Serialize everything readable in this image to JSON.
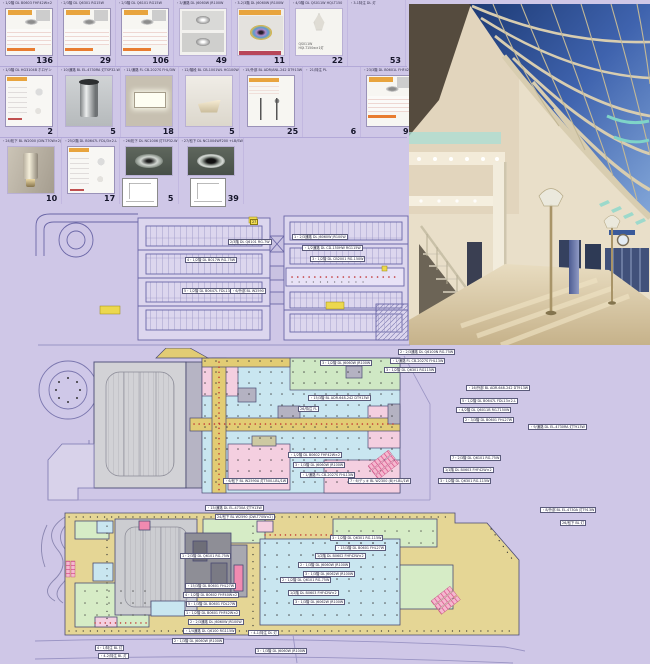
{
  "palette": {
    "page_bg": "#cfc7e7",
    "grid_line": "#b3a9d8",
    "plan_line": "#6a66a6",
    "plan_fill": "#dcd6ee",
    "zone_cyan": "#c9e6f0",
    "zone_pink": "#f4cfe0",
    "zone_green": "#d4ebc5",
    "zone_yellow": "#e2cc74",
    "zone_tan": "#e5d695",
    "zone_grey": "#cccdd1",
    "dot_red": "#c03030",
    "sky_blue": "#3c5ea8",
    "mullion_cream": "#d8cdb0",
    "teal_accent": "#7fd4c8",
    "floor_beige": "#d9c7a3"
  },
  "catalog": {
    "rows": [
      {
        "cards": [
          {
            "header": "・1/2階  DL  B0603  FHF42W×2",
            "number": "136",
            "variant": "sheet"
          },
          {
            "header": "・2/3階  DL  Q6301  RG15W",
            "number": "29",
            "variant": "sheet"
          },
          {
            "header": "・2/3階  DL  Q6101  RG15W",
            "number": "106",
            "variant": "sheet"
          },
          {
            "header": "・3/通路  DL  J6060W  JR100W",
            "number": "49",
            "variant": "stack"
          },
          {
            "header": "・3-2/3階  DL  J6060W  JR100W",
            "number": "11",
            "variant": "photoDL"
          },
          {
            "header": "・4/3階  DL  QS011W  HQI-T150",
            "number": "22",
            "variant": "sketch",
            "note": "QS011W\nHQI-T150w×1灯"
          },
          {
            "header": "・3-1特注  DL  灯",
            "number": "53",
            "variant": "empty"
          }
        ]
      },
      {
        "cards": [
          {
            "header": "・1/3階  DL  HG3104B  ホロゲン",
            "number": "2",
            "variant": "sheetB"
          },
          {
            "header": "・10/通路  BL  EL-4730RA  灯TSP32-W",
            "number": "5",
            "variant": "cylinder"
          },
          {
            "header": "・11/通路  FL  CB-2027S  FHL/3W",
            "number": "18",
            "variant": "rectlight"
          },
          {
            "header": "・12/階段  BL  CB-1001WL  HG100W",
            "number": "5",
            "variant": "wedge"
          },
          {
            "header": "・15/外部  BL  ADR/ANL-242  DT913W",
            "number": "25",
            "variant": "poleSheet"
          },
          {
            "header": "・ 21/特注  PL",
            "number": "6",
            "variant": "empty"
          },
          {
            "header": "・23/3階  DL  B0601L  FHF42W",
            "number": "97",
            "variant": "sheet"
          }
        ]
      },
      {
        "cards": [
          {
            "header": "・24/松下  BL  W2000  (DW-T70W×2)",
            "number": "10",
            "variant": "wallcyl"
          },
          {
            "header": "・25/2階  DL  B0647L  FDL/3×2-L",
            "number": "17",
            "variant": "sheetB"
          },
          {
            "header": "・26/松下  DL  NC1006  灯TSP32-W",
            "number": "5",
            "variant": "darkDL"
          },
          {
            "header": "・27/松下  DL  NC1004WF200  +LB/SW",
            "number": "39",
            "variant": "darkDL2"
          }
        ]
      }
    ]
  },
  "plans": {
    "cad": {
      "title": "parking-level-plan",
      "labels": [
        {
          "text": "4・1/2階  DL  B017W  RG-75W",
          "x": 155,
          "y": 49
        },
        {
          "text": "5・1/2階  DL  B0647L  FDL13-L",
          "x": 152,
          "y": 80
        },
        {
          "text": "1・2/3通路  DL  J6060W  JR100W",
          "x": 262,
          "y": 26
        },
        {
          "text": "・1/2通路  DL  CD-150HW  RG115W",
          "x": 272,
          "y": 37
        },
        {
          "text": "3・1/2階  DL  CB2001  RG-150W",
          "x": 280,
          "y": 48
        },
        {
          "text": "2/3階  DL  Q6101  RG-7W",
          "x": 198,
          "y": 31
        },
        {
          "text": "・6/外部  BL  W2590",
          "x": 200,
          "y": 80
        },
        {
          "text": "27",
          "x": 220,
          "y": 11,
          "variant": "yellow"
        }
      ]
    },
    "level1": {
      "title": "upper-floor-plan",
      "labels": [
        {
          "text": "2・2/3通路  DL  Q6100N  RG-75W",
          "x": 360,
          "y": 1
        },
        {
          "text": "・1/通路  FL  CB-2027S  FHL13W",
          "x": 352,
          "y": 10
        },
        {
          "text": "3・1/2階  DL  Q6301  RG115W",
          "x": 346,
          "y": 19
        },
        {
          "text": "3・1/2階  DL  J6060W  JR100W",
          "x": 282,
          "y": 12
        },
        {
          "text": "・16/外部  BL  ADR-648-242  DT913W",
          "x": 428,
          "y": 37
        },
        {
          "text": "5・1/2階  DL  B0647L  FDL13×2-L",
          "x": 422,
          "y": 50
        },
        {
          "text": "・4/2階  DL  Q6011B  RG-T150W",
          "x": 418,
          "y": 59
        },
        {
          "text": "2・3/3階  DL  B0601  FHL27W",
          "x": 425,
          "y": 69
        },
        {
          "text": "・15/3階  BL  ADR-648-242  DT913W",
          "x": 270,
          "y": 47
        },
        {
          "text": "26/特注  FL",
          "x": 260,
          "y": 58
        },
        {
          "text": "7・2/3階  DL  Q6101  RG-75W",
          "x": 412,
          "y": 107
        },
        {
          "text": "1/1階  DL  B0603  FHF42W×2",
          "x": 405,
          "y": 119
        },
        {
          "text": "3・1/2階  DL  Q6301  RG-115W",
          "x": 400,
          "y": 130
        },
        {
          "text": "・1/2階  DL  B0602  FHF42W×2",
          "x": 250,
          "y": 104
        },
        {
          "text": "3・1/3階  DL  J6060W  JR100W",
          "x": 255,
          "y": 114
        },
        {
          "text": "・1/通路  FL  CB-2027S  FHL13W",
          "x": 262,
          "y": 124
        },
        {
          "text": "・9/通路  DL  EL-4730RA  灯T913W",
          "x": 490,
          "y": 76
        },
        {
          "text": "・6/松下  BL  W2590A  灯T500-LBL/1W",
          "x": 185,
          "y": 130
        },
        {
          "text": "7・6/デッキ  BL  W2300  (B)+LBL/1W",
          "x": 310,
          "y": 130
        }
      ]
    },
    "ground": {
      "title": "ground-floor-plan",
      "labels": [
        {
          "text": "・8/外部  BL  EL-4730A  灯T913W",
          "x": 505,
          "y": 2
        },
        {
          "text": "26/松下  BL  灯",
          "x": 525,
          "y": 15
        },
        {
          "text": "・15/通路  DL  EL-4730A  灯T913W",
          "x": 170,
          "y": 0
        },
        {
          "text": "24/松下  BL  W2590  (DW-T70W×2)",
          "x": 180,
          "y": 9
        },
        {
          "text": "3・1/2階  DL  Q6301  RG-115W",
          "x": 295,
          "y": 30
        },
        {
          "text": "・15/3階  DL  B0601  FHL27W",
          "x": 300,
          "y": 40
        },
        {
          "text": "1/2階  DL  B0602  FHF42W×2",
          "x": 280,
          "y": 48
        },
        {
          "text": "2・1/3階  DL  J6060W  JR100W",
          "x": 263,
          "y": 57
        },
        {
          "text": "3・1/3階  DL  J6062W  JR100W",
          "x": 268,
          "y": 66
        },
        {
          "text": "1・2/3階  DL  Q6101  RG-75W",
          "x": 145,
          "y": 48
        },
        {
          "text": "2・1/2階  DL  Q6101  RG-75W",
          "x": 245,
          "y": 72
        },
        {
          "text": "・15/3階  DL  B0601  FHL27W",
          "x": 150,
          "y": 78
        },
        {
          "text": "4・1/2階  DL  B0602  FHF40W×2",
          "x": 148,
          "y": 87
        },
        {
          "text": "5・1/3階  DL  B0601  FDL27W",
          "x": 151,
          "y": 96
        },
        {
          "text": "1・1/2階  DL  B0601  FHF42W×2",
          "x": 149,
          "y": 105
        },
        {
          "text": "2・2/3通路  DL  J6060W  JR100W",
          "x": 153,
          "y": 114
        },
        {
          "text": "・1/4通路  DL  Q6100  RG115W",
          "x": 148,
          "y": 123
        },
        {
          "text": "1/2階  DL  B0603  FHF42W×2",
          "x": 253,
          "y": 85
        },
        {
          "text": "3・1/3階  DL  J6062W  JR100W",
          "x": 258,
          "y": 94
        },
        {
          "text": "2・1/3階  DL  J6060W  JR100W",
          "x": 137,
          "y": 133
        },
        {
          "text": "3・1/3階  DL  J6060W  JR100W",
          "x": 220,
          "y": 143
        },
        {
          "text": "・4-1/特注  DL  灯",
          "x": 213,
          "y": 125
        },
        {
          "text": "4・1/特注  BL  灯",
          "x": 60,
          "y": 140
        },
        {
          "text": "・4-2/特注  BL  灯",
          "x": 63,
          "y": 148
        }
      ]
    }
  }
}
